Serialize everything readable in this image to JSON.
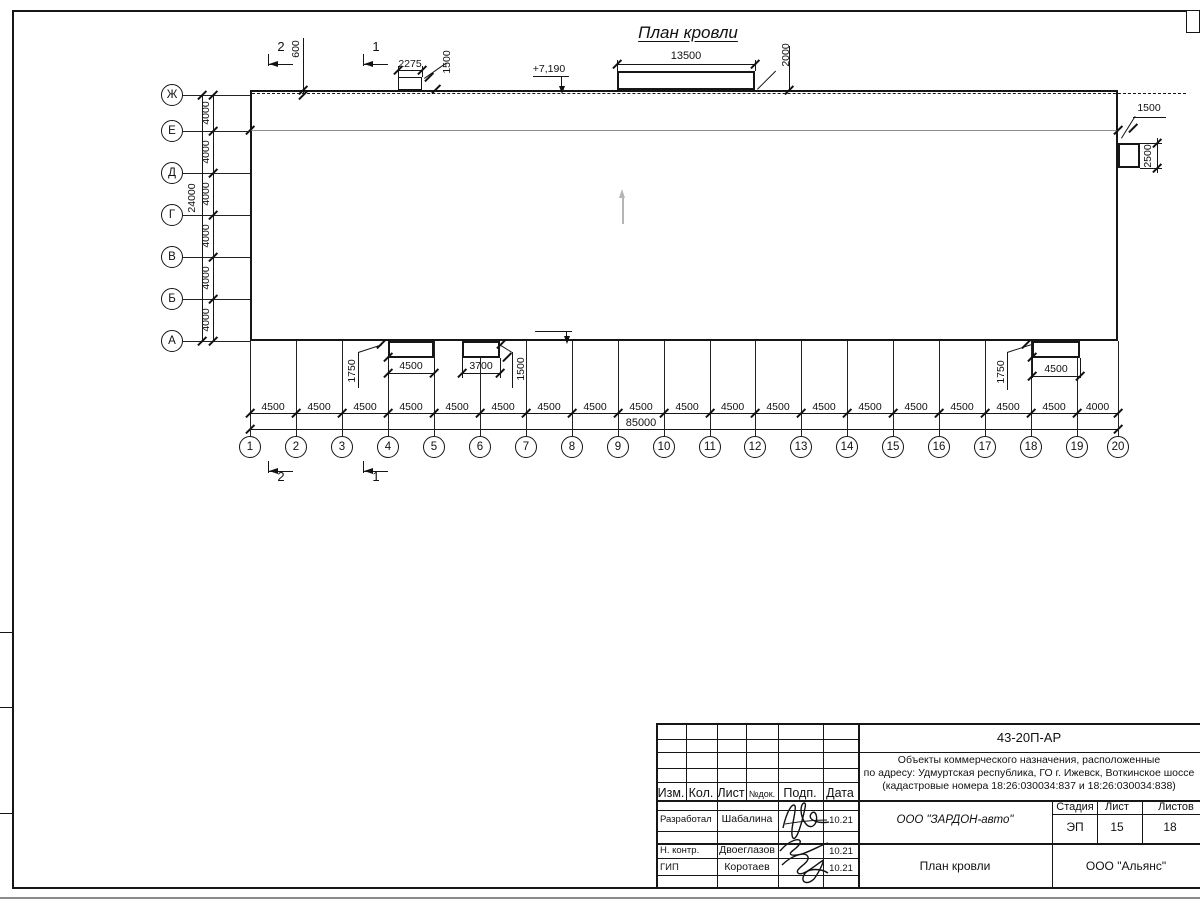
{
  "drawing": {
    "title": "План кровли",
    "slope": "2°",
    "elev_top": "+7,190",
    "elev_bottom": "+7,870",
    "roof_total_width": "85000",
    "eaves_offset": "600",
    "section_cut_1": "1",
    "section_cut_2": "2",
    "top_small_box": {
      "width": "2275",
      "depth": "1500"
    },
    "top_big_box": {
      "width": "13500",
      "depth": "2000"
    },
    "right_box": {
      "width": "1500",
      "height": "2500"
    },
    "bottom_boxes": [
      {
        "width": "4500",
        "depth": "1750"
      },
      {
        "width": "3700",
        "depth": "1500"
      },
      {
        "width": "4500",
        "depth": "1750"
      }
    ]
  },
  "axes": {
    "letters": [
      "Ж",
      "Е",
      "Д",
      "Г",
      "В",
      "Б",
      "А"
    ],
    "letter_spacing": "4000",
    "letters_total": "24000",
    "numbers": [
      "1",
      "2",
      "3",
      "4",
      "5",
      "6",
      "7",
      "8",
      "9",
      "10",
      "11",
      "12",
      "13",
      "14",
      "15",
      "16",
      "17",
      "18",
      "19",
      "20"
    ],
    "number_spacings": [
      "4500",
      "4500",
      "4500",
      "4500",
      "4500",
      "4500",
      "4500",
      "4500",
      "4500",
      "4500",
      "4500",
      "4500",
      "4500",
      "4500",
      "4500",
      "4500",
      "4500",
      "4500",
      "4000"
    ],
    "numbers_total": "85000"
  },
  "title_block": {
    "doc_number": "43-20П-АР",
    "project_line1": "Объекты коммерческого назначения, расположенные",
    "project_line2": "по адресу: Удмуртская республика, ГО г. Ижевск, Воткинское шоссе",
    "project_line3": "(кадастровые номера 18:26:030034:837 и 18:26:030034:838)",
    "header_cols": [
      "Изм.",
      "Кол.",
      "Лист",
      "№док.",
      "Подп.",
      "Дата"
    ],
    "rows": [
      {
        "role": "Разработал",
        "name": "Шабалина",
        "date": "10.21"
      },
      {
        "role": "Н. контр.",
        "name": "Двоеглазов",
        "date": "10.21"
      },
      {
        "role": "ГИП",
        "name": "Коротаев",
        "date": "10.21"
      }
    ],
    "company": "ООО \"ЗАРДОН-авто\"",
    "stage_label": "Стадия",
    "sheet_label": "Лист",
    "sheets_label": "Листов",
    "stage": "ЭП",
    "sheet": "15",
    "sheets": "18",
    "sheet_title": "План кровли",
    "org": "ООО \"Альянс\""
  }
}
